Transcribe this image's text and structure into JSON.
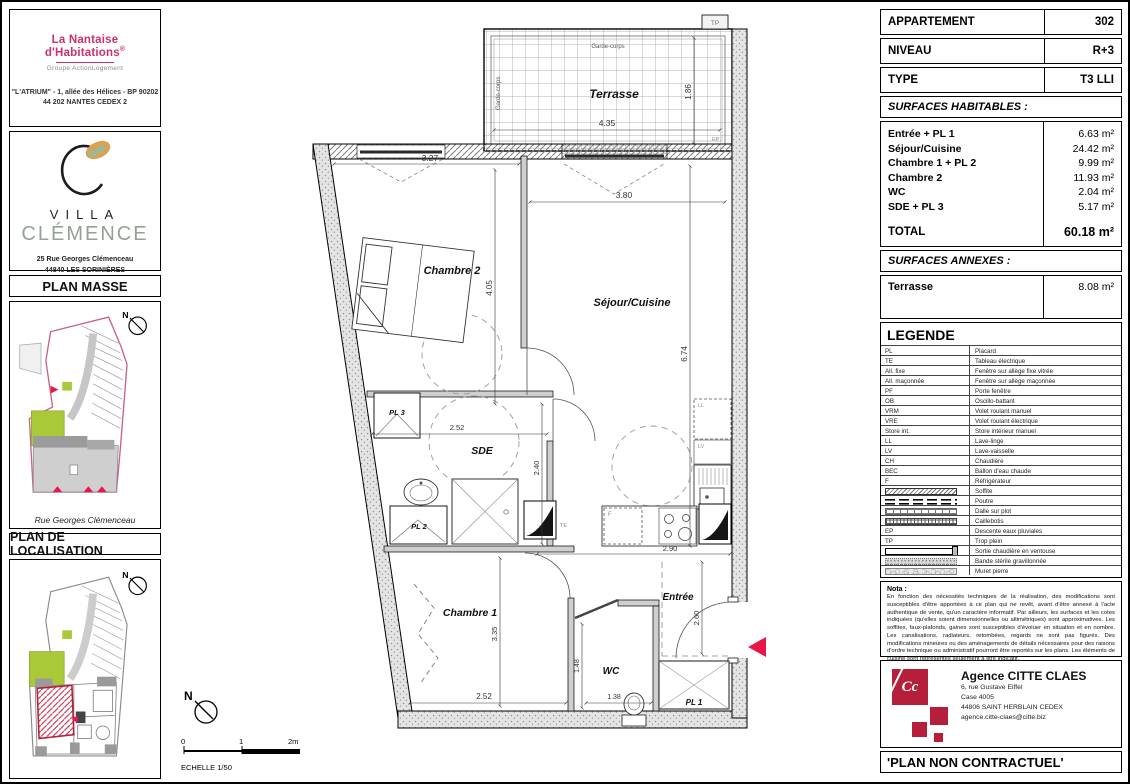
{
  "sidebar": {
    "nantaise": {
      "brand": "La Nantaise d'Habitations",
      "brand_mark": "®",
      "group": "Groupe ActionLogement",
      "address_line1": "\"L'ATRIUM\" - 1, allée des Hélices - BP 90202",
      "address_line2": "44 202 NANTES CEDEX 2"
    },
    "villa": {
      "name_line1": "VILLA",
      "name_line2": "CLÉMENCE",
      "address_line1": "25 Rue Georges Clémenceau",
      "address_line2": "44840 LES SORINIÈRES"
    },
    "plan_masse": {
      "title": "PLAN MASSE",
      "caption": "Rue Georges Clémenceau",
      "north": "N"
    },
    "plan_localisation": {
      "title": "PLAN DE LOCALISATION",
      "north": "N"
    }
  },
  "plan": {
    "labels": {
      "terrasse": "Terrasse",
      "garde_corps": "Garde-corps",
      "chambre2": "Chambre 2",
      "sejour_cuisine": "Séjour/Cuisine",
      "pl3": "PL 3",
      "sde": "SDE",
      "pl2": "PL 2",
      "chambre1": "Chambre 1",
      "wc": "WC",
      "entree": "Entrée",
      "pl1": "PL 1",
      "te": "TE",
      "ll": "LL",
      "lv": "LV",
      "f": "F",
      "tp": "TP",
      "ep": "EP",
      "north": "N"
    },
    "dimensions": {
      "terrasse_width": "4.35",
      "terrasse_depth": "1.86",
      "chambre2_width": "3.27",
      "chambre2_depth": "4.05",
      "sejour_width": "3.80",
      "sejour_depth": "6.74",
      "sde_width": "2.52",
      "sde_depth": "2.40",
      "cuisine_width": "2.90",
      "chambre1_depth": "3.35",
      "chambre1_width": "2.52",
      "wc_depth": "1.48",
      "wc_width": "1.38",
      "entree_depth": "2.60"
    },
    "scale": {
      "tick0": "0",
      "tick1": "1",
      "tick2": "2m",
      "label": "ECHELLE 1/50"
    }
  },
  "info_panel": {
    "header_rows": [
      {
        "label": "APPARTEMENT",
        "value": "302"
      },
      {
        "label": "NIVEAU",
        "value": "R+3"
      },
      {
        "label": "TYPE",
        "value": "T3 LLI"
      }
    ],
    "surfaces_habitables": {
      "title": "SURFACES HABITABLES :",
      "rows": [
        {
          "label": "Entrée + PL 1",
          "value": "6.63 m²"
        },
        {
          "label": "Séjour/Cuisine",
          "value": "24.42 m²"
        },
        {
          "label": "Chambre 1 + PL 2",
          "value": "9.99 m²"
        },
        {
          "label": "Chambre 2",
          "value": "11.93 m²"
        },
        {
          "label": "WC",
          "value": "2.04 m²"
        },
        {
          "label": "SDE + PL 3",
          "value": "5.17 m²"
        }
      ],
      "total_label": "TOTAL",
      "total_value": "60.18 m²"
    },
    "surfaces_annexes": {
      "title": "SURFACES ANNEXES :",
      "rows": [
        {
          "label": "Terrasse",
          "value": "8.08 m²"
        }
      ]
    },
    "legend": {
      "title": "LEGENDE",
      "items": [
        {
          "key": "PL",
          "label": "Placard"
        },
        {
          "key": "TE",
          "label": "Tableau électrique"
        },
        {
          "key": "All. fixe",
          "label": "Fenêtre sur allège fixe vitrée"
        },
        {
          "key": "All. maçonnée",
          "label": "Fenêtre sur allège maçonnée"
        },
        {
          "key": "PF",
          "label": "Porte fenêtre"
        },
        {
          "key": "OB",
          "label": "Oscillo-battant"
        },
        {
          "key": "VRM",
          "label": "Volet roulant manuel"
        },
        {
          "key": "VRE",
          "label": "Volet roulant électrique"
        },
        {
          "key": "Store int.",
          "label": "Store intérieur manuel"
        },
        {
          "key": "LL",
          "label": "Lave-linge"
        },
        {
          "key": "LV",
          "label": "Lave-vaisselle"
        },
        {
          "key": "CH",
          "label": "Chaudière"
        },
        {
          "key": "BEC",
          "label": "Ballon d'eau chaude"
        },
        {
          "key": "F",
          "label": "Réfrigérateur"
        },
        {
          "key": "",
          "swatch": "soffite",
          "label": "Soffite"
        },
        {
          "key": "",
          "swatch": "poutre",
          "label": "Poutre"
        },
        {
          "key": "",
          "swatch": "dalle",
          "label": "Dalle sur plot"
        },
        {
          "key": "",
          "swatch": "caillebotis",
          "label": "Caillebotis"
        },
        {
          "key": "EP",
          "label": "Descente eaux pluviales"
        },
        {
          "key": "TP",
          "label": "Trop plein"
        },
        {
          "key": "",
          "swatch": "ventouse",
          "label": "Sortie chaudière en ventouse"
        },
        {
          "key": "",
          "swatch": "gravillon",
          "label": "Bande stérile gravillonnée"
        },
        {
          "key": "",
          "swatch": "muret",
          "label": "Muret pierre"
        }
      ]
    },
    "nota": {
      "title": "Nota :",
      "text": "En fonction des nécessités techniques de la réalisation, des modifications sont susceptibles d'être apportées à ce plan qui ne revêt, avant d'être annexé à l'acte authentique de vente, qu'un caractère informatif. Par ailleurs, les surfaces et les cotes indiquées (qu'elles soient dimensionnelles ou altimétriques) sont approximatives. Les soffites, faux-plafonds, gaines sont susceptibles d'évoluer en situation et en nombre. Les canalisations, radiateurs, retombées, regards ne sont pas figurés. Des modifications mineures ou des aménagements de détails nécessaires pour des raisons d'ordre technique ou administratif pourront être reportés sur les plans. Les éléments de cuisine sont représentés seulement à titre indicatif."
    },
    "agency": {
      "name": "Agence CITTE CLAES",
      "logo_text": "Cc",
      "address_line1": "6, rue Gustave Eiffel",
      "address_line2": "Case 4005",
      "address_line3": "44806 SAINT HERBLAIN CEDEX",
      "email": "agence.citte-claes@citte.biz"
    },
    "footer": "'PLAN NON CONTRACTUEL'"
  },
  "colors": {
    "brand_pink": "#cf2f6e",
    "villa_green": "#93a296",
    "leaf_orange": "#dfa050",
    "leaf_green": "#9cb98f",
    "accent_red": "#b51f3c",
    "arrow_red": "#e8174a",
    "site_green": "#a9c939",
    "site_pink": "#c96487"
  }
}
